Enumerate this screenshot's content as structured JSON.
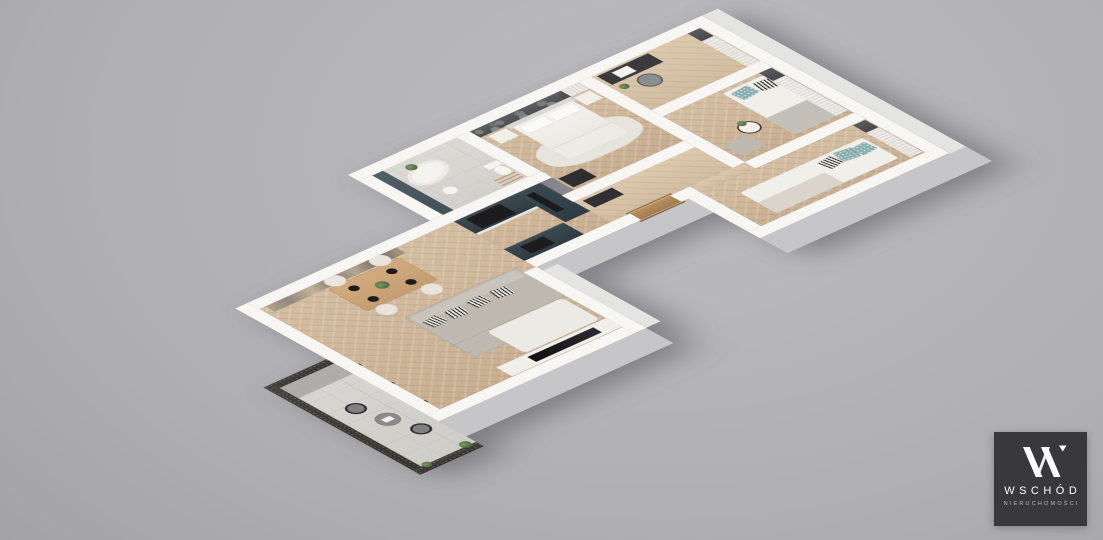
{
  "scene": {
    "type": "3d-isometric-floorplan-render",
    "rooms": [
      "balcony",
      "living-dining-room",
      "kitchen",
      "bathroom",
      "main-bedroom",
      "hallway",
      "office-room",
      "kids-room",
      "guest-bedroom"
    ]
  },
  "logo": {
    "monogram": "W",
    "name": "WSCHÓD",
    "subtitle": "NIERUCHOMOŚCI",
    "background": "#39393c",
    "text_color": "#ffffff"
  },
  "colors": {
    "background_light": "#bdbdc1",
    "background_dark": "#8f8f93",
    "wall_white": "#f7f6f3",
    "wood_floor": "#cdb497",
    "bath_tile": "#d8d6d1",
    "balcony_tile": "#d5d3ce",
    "balcony_dark_wall": "#46423c",
    "kitchen_cabinet_teal": "#35444c",
    "slate_feature_wall": "#49585e",
    "bedroom_wallpaper_gray": "#55585b",
    "mural_tan": "#b3a28b",
    "sofa_gray": "#bdb9b1",
    "teal_pillow": "#87aeb0",
    "appliance_black": "#1c1c1e"
  }
}
